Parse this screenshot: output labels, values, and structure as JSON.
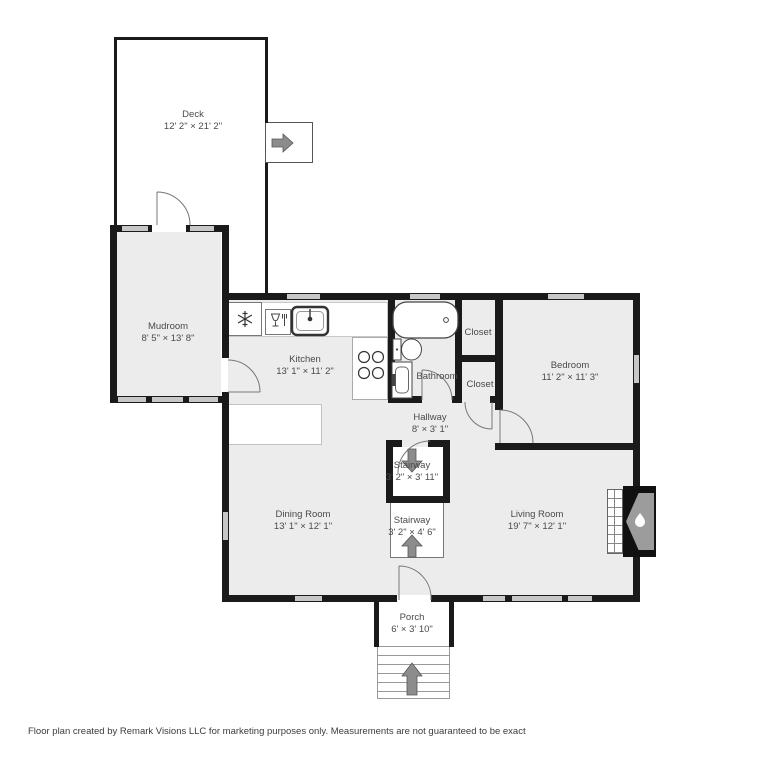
{
  "title": "Floor plan",
  "colors": {
    "wall": "#1a1a1a",
    "room_fill": "#ececec",
    "window": "#c7c7c7",
    "label": "#4a4a4a",
    "arrow": "#8c8c8c",
    "fixture": "#444444"
  },
  "rooms": {
    "deck": {
      "name": "Deck",
      "dims": "12' 2\" × 21' 2\""
    },
    "mudroom": {
      "name": "Mudroom",
      "dims": "8' 5\" × 13' 8\""
    },
    "kitchen": {
      "name": "Kitchen",
      "dims": "13' 1\" × 11' 2\""
    },
    "bathroom": {
      "name": "Bathroom"
    },
    "closet_upper": {
      "name": "Closet"
    },
    "closet_lower": {
      "name": "Closet"
    },
    "bedroom": {
      "name": "Bedroom",
      "dims": "11' 2\" × 11' 3\""
    },
    "hallway": {
      "name": "Hallway",
      "dims": "8' × 3' 1\""
    },
    "stairway_upper": {
      "name": "Stairway",
      "dims": "3' 2\" × 3' 11\""
    },
    "stairway_lower": {
      "name": "Stairway",
      "dims": "3' 2\" × 4' 6\""
    },
    "dining_room": {
      "name": "Dining Room",
      "dims": "13' 1\" × 12' 1\""
    },
    "living_room": {
      "name": "Living Room",
      "dims": "19' 7\" × 12' 1\""
    },
    "porch": {
      "name": "Porch",
      "dims": "6' × 3' 10\""
    }
  },
  "icons": {
    "refrigerator": "snowflake-icon",
    "dishwasher": "glass-and-fork-icon",
    "kitchen_sink": "sink-icon",
    "stove": "four-burner-icon",
    "bathtub": "bathtub-icon",
    "toilet": "toilet-icon",
    "vanity": "vanity-sink-icon",
    "fireplace": "flame-icon",
    "deck_stairs": "arrow-right-icon",
    "upper_stairway": "arrow-down-icon",
    "lower_stairway": "arrow-up-icon",
    "porch_stairs": "arrow-up-icon"
  },
  "footer": {
    "disclaimer": "Floor plan created by Remark Visions LLC for marketing purposes only. Measurements are not guaranteed to be exact"
  }
}
